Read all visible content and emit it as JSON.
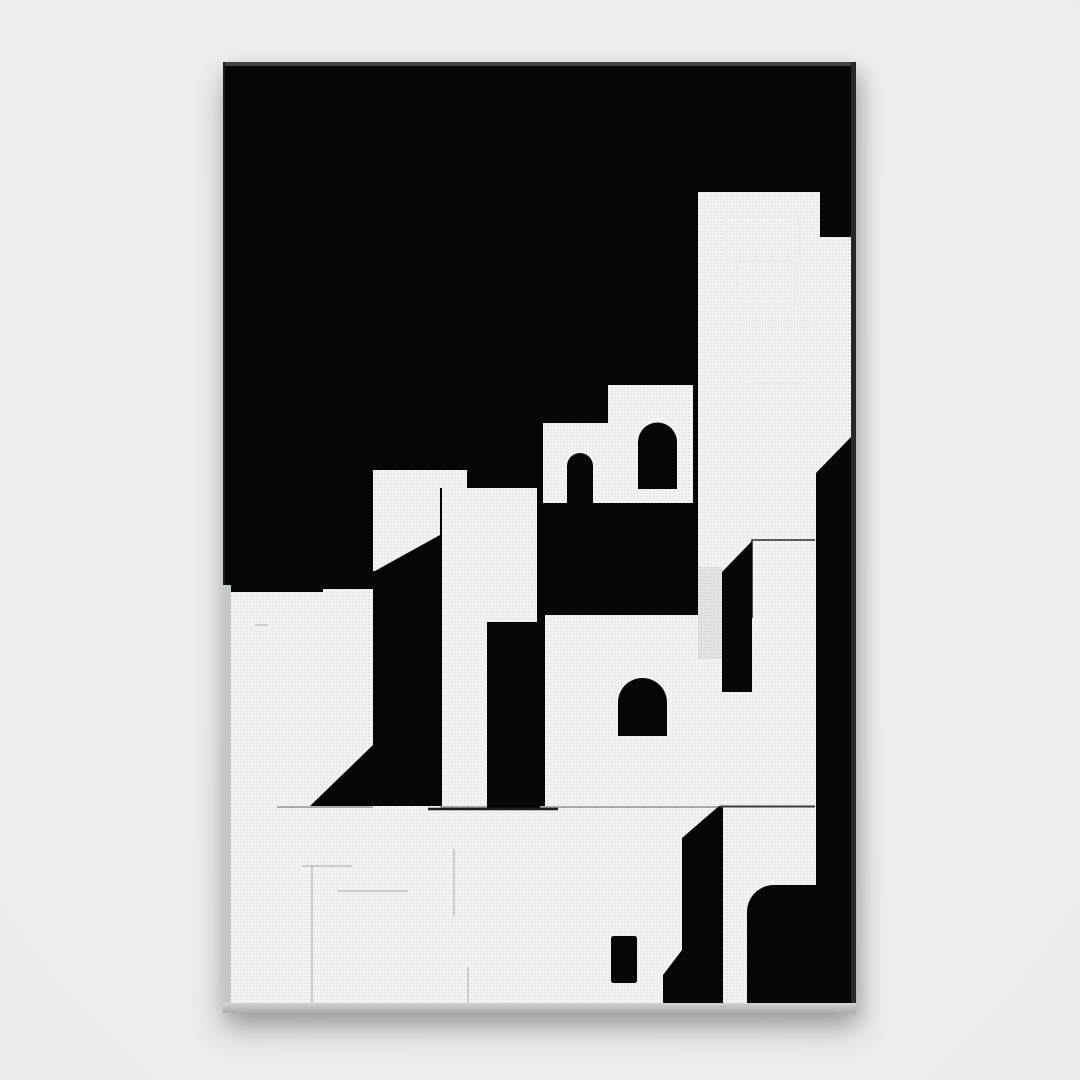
{
  "page": {
    "background_color": "#eef0f1"
  },
  "artwork": {
    "description": "Black and white minimalist illustration of stacked cubic whitewashed buildings with arched doorways and cast shadows, printed on a portrait canvas with a thin dark frame, photographed on a light gray wall",
    "orientation": "portrait",
    "palette": {
      "ink_black": "#060606",
      "paper_white": "#f5f6f6",
      "halftone_dot": "#d8dbdc",
      "shadow_halftone": "#c9cdce",
      "canvas_side_gray": "#c5c8c9",
      "frame_edge": "#26292b",
      "sketch_line_gray": "#9aa0a2"
    },
    "motifs": [
      "stepped buildings",
      "arched doorways",
      "towers",
      "diagonal cast shadows",
      "halftone print texture",
      "thin sketched plan lines",
      "small dark doorway"
    ]
  }
}
